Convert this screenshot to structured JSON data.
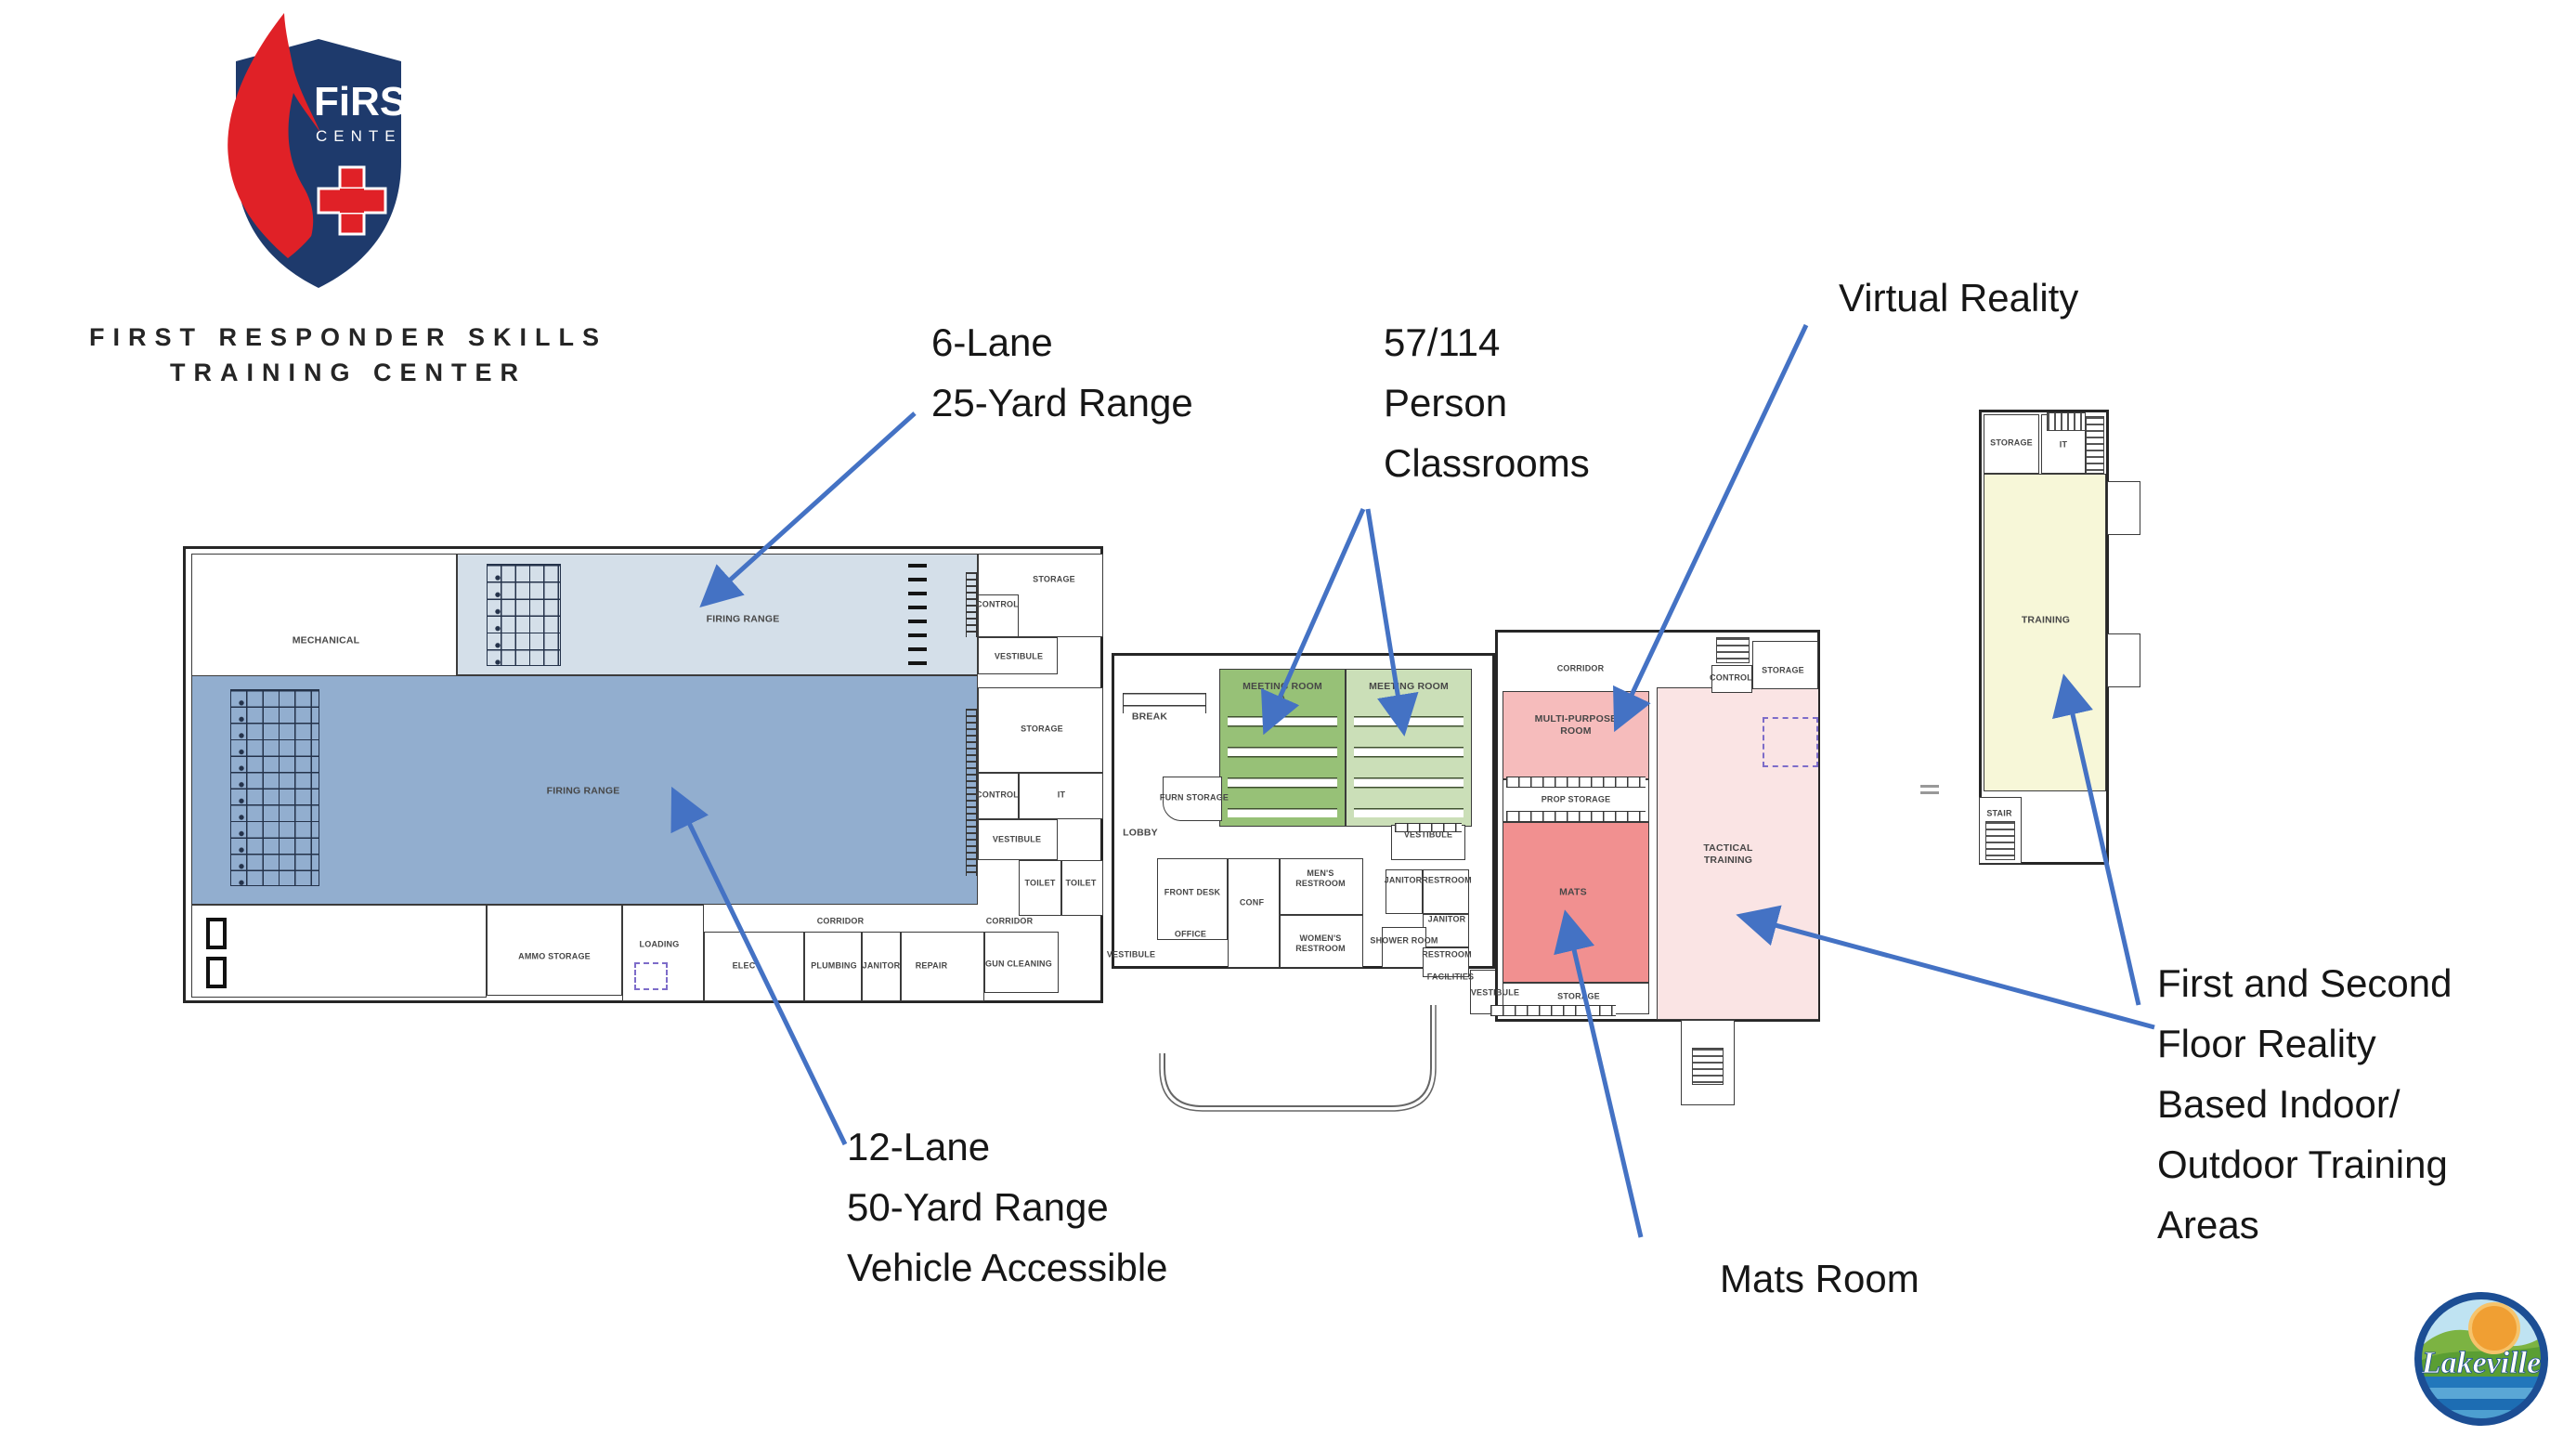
{
  "logo": {
    "shield_top": "FiRST",
    "shield_sub": "CENTER",
    "title1": "FIRST RESPONDER SKILLS",
    "title2": "TRAINING CENTER"
  },
  "annotations": {
    "six": "6-Lane\n25-Yard Range",
    "classrooms": "57/114\nPerson\nClassrooms",
    "vr": "Virtual Reality",
    "twelve": "12-Lane\n50-Yard Range\nVehicle Accessible",
    "mats": "Mats Room",
    "training_areas": "First and Second\nFloor Reality\nBased Indoor/\nOutdoor Training\nAreas"
  },
  "plan": {
    "rooms": {
      "mechanical": "MECHANICAL",
      "firing_range": "FIRING RANGE",
      "storage": "STORAGE",
      "control": "CONTROL",
      "vestibule": "VESTIBULE",
      "it": "IT",
      "toilet": "TOILET",
      "corridor": "CORRIDOR",
      "ammo_storage": "AMMO STORAGE",
      "loading": "LOADING",
      "elec": "ELEC",
      "plumbing": "PLUMBING",
      "janitor": "JANITOR",
      "repair": "REPAIR",
      "gun_cleaning": "GUN CLEANING",
      "break_room": "BREAK",
      "meeting_room": "MEETING ROOM",
      "unit_a": "A",
      "unit_b": "B",
      "furn_storage": "FURN STORAGE",
      "lobby": "LOBBY",
      "front_desk": "FRONT DESK",
      "office": "OFFICE",
      "conf": "CONF",
      "mens": "MEN'S",
      "womens": "WOMEN'S",
      "restroom": "RESTROOM",
      "shower_room": "SHOWER ROOM",
      "facilities": "FACILITIES",
      "multi_purpose": "MULTI-PURPOSE",
      "room_word": "ROOM",
      "prop_storage": "PROP STORAGE",
      "mats": "MATS",
      "tactical": "TACTICAL",
      "training": "TRAINING",
      "stair": "STAIR"
    }
  },
  "footer": {
    "city": "Lakeville"
  },
  "colors": {
    "arrow": "#4472c4",
    "range6": "#d4dfe9",
    "range12": "#92aecf",
    "meeting_a": "#97c177",
    "meeting_b": "#cbdfb8",
    "multi": "#f6bcbc",
    "mats": "#f19090",
    "tactical": "#fae4e4",
    "training": "#f7f7d8",
    "navy": "#1e3a6c",
    "brand_red": "#e02127"
  }
}
